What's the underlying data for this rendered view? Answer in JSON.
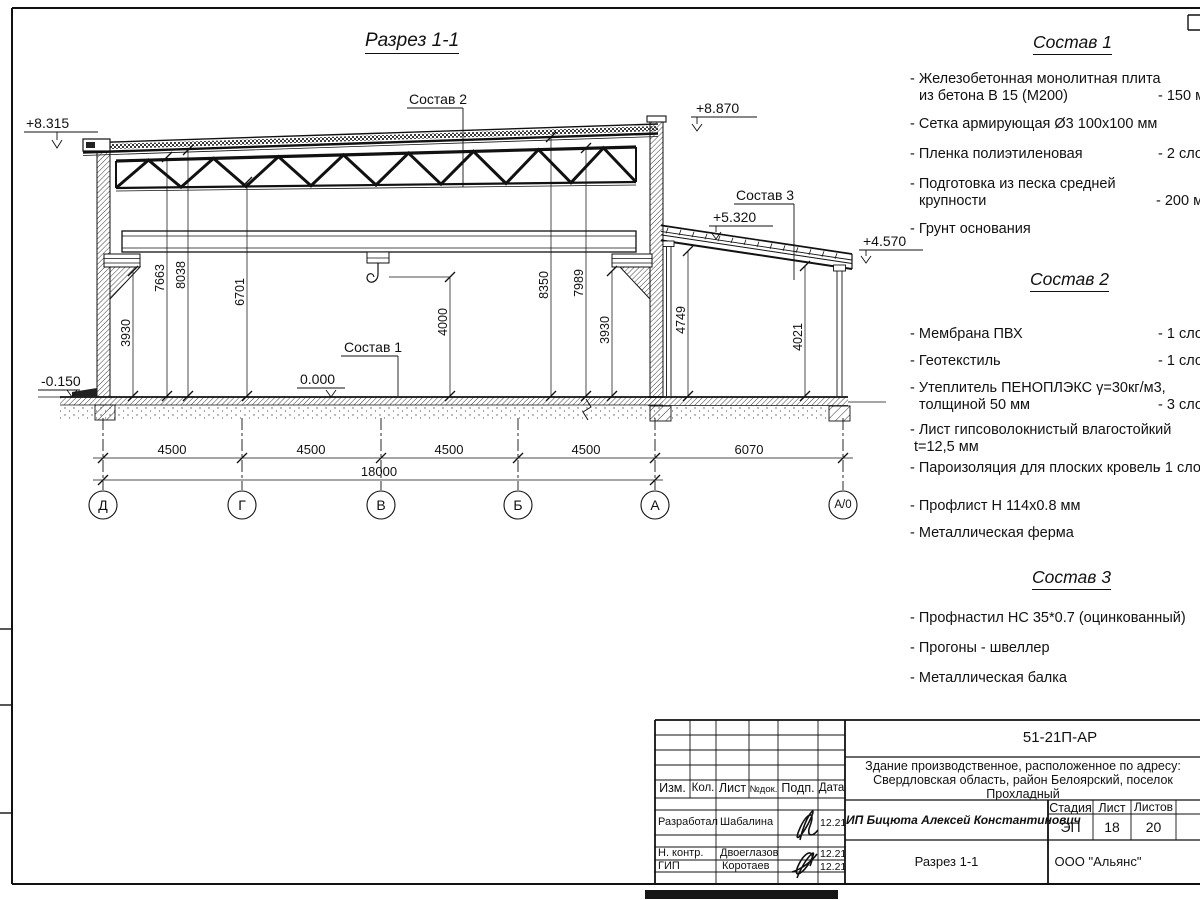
{
  "drawing": {
    "title": "Разрез 1-1",
    "elevations": [
      "+8.315",
      "+8.870",
      "+5.320",
      "+4.570",
      "0.000",
      "-0.150"
    ],
    "leader_labels": [
      "Состав 2",
      "Состав 3",
      "Состав 1"
    ],
    "vdims": [
      "3930",
      "7663",
      "8038",
      "6701",
      "4000",
      "8350",
      "7989",
      "3930",
      "4749",
      "4021"
    ],
    "hdims": [
      "4500",
      "4500",
      "4500",
      "4500",
      "6070"
    ],
    "total_dim": "18000",
    "axes": [
      "Д",
      "Г",
      "В",
      "Б",
      "А",
      "А/0"
    ]
  },
  "lists": {
    "s1": {
      "title": "Состав 1",
      "items": [
        {
          "l1": "- Железобетонная  монолитная плита",
          "l2": "из бетона В 15 (М200)",
          "v": "- 150 мм"
        },
        {
          "l1": "- Сетка армирующая Ø3 100х100 мм"
        },
        {
          "l1": "- Пленка полиэтиленовая",
          "v": "- 2 слоя"
        },
        {
          "l1": "- Подготовка из песка средней",
          "l2": "крупности",
          "v": "- 200 мм"
        },
        {
          "l1": "- Грунт основания"
        }
      ]
    },
    "s2": {
      "title": "Состав 2",
      "items": [
        {
          "l1": "- Мембрана ПВХ",
          "v": "- 1 слой"
        },
        {
          "l1": "- Геотекстиль",
          "v": "- 1 слой"
        },
        {
          "l1": "- Утеплитель ПЕНОПЛЭКС γ=30кг/м3,",
          "l2": "толщиной 50 мм",
          "v": "- 3 слоя"
        },
        {
          "l1": "- Лист гипсоволокнистый влагостойкий",
          "l2": "t=12,5 мм"
        },
        {
          "l1": "- Пароизоляция для плоских кровель",
          "v": "- 1 слой"
        },
        {
          "l1": "- Профлист Н 114х0.8 мм"
        },
        {
          "l1": "- Металлическая ферма"
        }
      ]
    },
    "s3": {
      "title": "Состав 3",
      "items": [
        {
          "l1": "- Профнастил НС 35*0.7 (оцинкованный)"
        },
        {
          "l1": "- Прогоны - швеллер"
        },
        {
          "l1": "- Металлическая балка"
        }
      ]
    }
  },
  "titleblock": {
    "code": "51-21П-АР",
    "object": "Здание производственное, расположенное по адресу: Свердловская область, район Белоярский, поселок Прохладный",
    "cols": [
      "Изм.",
      "Кол.",
      "Лист",
      "№док.",
      "Подп.",
      "Дата"
    ],
    "rows": [
      {
        "role": "Разработал",
        "name": "Шабалина",
        "date": "12.21"
      },
      {
        "role": "Н. контр.",
        "name": "Двоеглазов",
        "date": "12.21"
      },
      {
        "role": "ГИП",
        "name": "Коротаев",
        "date": "12.21"
      }
    ],
    "person": "ИП Бицюта Алексей Константинович",
    "stage_label": "Стадия",
    "sheet_label": "Лист",
    "sheets_label": "Листов",
    "stage": "ЭП",
    "sheet": "18",
    "sheets": "20",
    "drawing_name": "Разрез 1-1",
    "org": "ООО \"Альянс\""
  }
}
